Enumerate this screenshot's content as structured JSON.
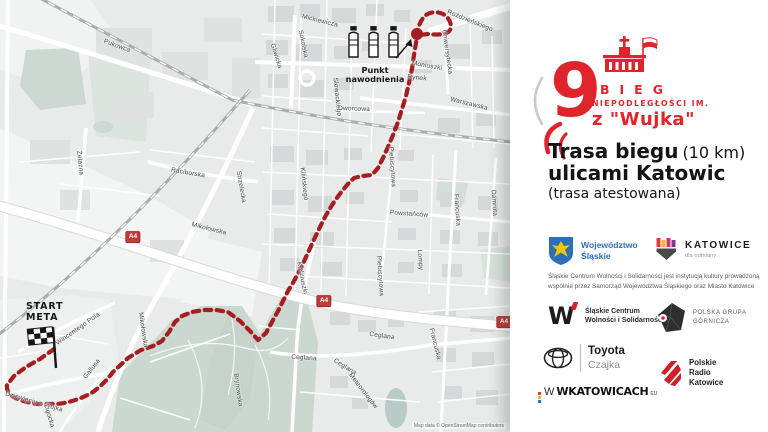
{
  "theme": {
    "route_red": "#a51e21",
    "brand_red": "#e0242c",
    "map_bg": "#e9ebea",
    "park_green": "#cbd8d0",
    "building_gray": "#d6d9d9",
    "road_white": "#ffffff",
    "railway_gray": "#a8aeae",
    "motorway_badge_red": "#c23b3b",
    "slaskie_blue": "#2a70ba",
    "eagle_yellow": "#f6c700"
  },
  "map": {
    "attribution": "Map data © OpenStreetMap contributors",
    "start_marker": {
      "line1": "START",
      "line2": "META"
    },
    "water_point": {
      "line1": "Punkt",
      "line2": "nawodnienia"
    },
    "motorway_badges": [
      {
        "label": "A4",
        "x": 133,
        "y": 237
      },
      {
        "label": "A4",
        "x": 324,
        "y": 301
      },
      {
        "label": "A4",
        "x": 504,
        "y": 322
      }
    ],
    "street_labels": [
      {
        "t": "Pukowca",
        "x": 117,
        "y": 46,
        "r": 20
      },
      {
        "t": "Mickiewicza",
        "x": 320,
        "y": 21,
        "r": 14
      },
      {
        "t": "Sokolska",
        "x": 303,
        "y": 44,
        "r": 78
      },
      {
        "t": "Gliwicka",
        "x": 276,
        "y": 56,
        "r": 72
      },
      {
        "t": "Roździeńskiego",
        "x": 470,
        "y": 21,
        "r": 22
      },
      {
        "t": "Uniwersytecka",
        "x": 447,
        "y": 52,
        "r": 82
      },
      {
        "t": "Moniuszki",
        "x": 427,
        "y": 66,
        "r": 10
      },
      {
        "t": "Rynek",
        "x": 417,
        "y": 78,
        "r": 6
      },
      {
        "t": "Warszawska",
        "x": 469,
        "y": 104,
        "r": 14
      },
      {
        "t": "Słowackiego",
        "x": 337,
        "y": 97,
        "r": 84
      },
      {
        "t": "Dworcowa",
        "x": 354,
        "y": 109,
        "r": 2
      },
      {
        "t": "Żelazna",
        "x": 80,
        "y": 163,
        "r": 84
      },
      {
        "t": "Raciborska",
        "x": 188,
        "y": 173,
        "r": 10
      },
      {
        "t": "Strzelecka",
        "x": 241,
        "y": 187,
        "r": 80
      },
      {
        "t": "Mikołowska",
        "x": 209,
        "y": 229,
        "r": 14
      },
      {
        "t": "Kilińskiego",
        "x": 304,
        "y": 184,
        "r": 84
      },
      {
        "t": "Plebiscytowa",
        "x": 392,
        "y": 167,
        "r": 86
      },
      {
        "t": "Plebiscytowa",
        "x": 380,
        "y": 276,
        "r": 86
      },
      {
        "t": "Powstańców",
        "x": 409,
        "y": 214,
        "r": 4
      },
      {
        "t": "Francuska",
        "x": 457,
        "y": 210,
        "r": 86
      },
      {
        "t": "Damrota",
        "x": 494,
        "y": 203,
        "r": 86
      },
      {
        "t": "Lompy",
        "x": 420,
        "y": 260,
        "r": 86
      },
      {
        "t": "Kościuszki",
        "x": 302,
        "y": 278,
        "r": 78
      },
      {
        "t": "Wincentego Pola",
        "x": 78,
        "y": 329,
        "r": -35
      },
      {
        "t": "Gallusa",
        "x": 92,
        "y": 369,
        "r": -52
      },
      {
        "t": "Mikołowska",
        "x": 143,
        "y": 330,
        "r": 82
      },
      {
        "t": "Dziewięciu z Wujka",
        "x": 34,
        "y": 402,
        "r": 16
      },
      {
        "t": "Ligocka",
        "x": 49,
        "y": 416,
        "r": 74
      },
      {
        "t": "Brynowska",
        "x": 238,
        "y": 390,
        "r": 82
      },
      {
        "t": "Ceglana",
        "x": 382,
        "y": 336,
        "r": 8
      },
      {
        "t": "Ceglana",
        "x": 304,
        "y": 358,
        "r": 4
      },
      {
        "t": "Ceglana",
        "x": 345,
        "y": 367,
        "r": 32
      },
      {
        "t": "Meteorologów",
        "x": 363,
        "y": 391,
        "r": 52
      },
      {
        "t": "Francuska",
        "x": 435,
        "y": 344,
        "r": 76
      }
    ]
  },
  "panel": {
    "logo": {
      "number": "9",
      "line1": "BIEG",
      "line2": "NIEPODLEGŁOŚCI IM.",
      "line3": "z \"Wujka\""
    },
    "title": {
      "bold1": "Trasa biegu",
      "normal1": "(10 km)",
      "bold2": "ulicami Katowic",
      "normal2": "(trasa atestowana)"
    },
    "note": "Śląskie Centrum Wolności i Solidarności jest instytucją kultury prowadzoną wspólnie przez Samorząd Województwa Śląskiego oraz Miasto Katowice",
    "logos": {
      "slaskie": {
        "line1": "Województwo",
        "line2": "Śląskie"
      },
      "katowice": {
        "name": "KATOWICE",
        "tagline": "dla odmiany"
      },
      "scws": {
        "line1": "Śląskie Centrum",
        "line2": "Wolności i Solidarności"
      },
      "pgg": {
        "line1": "POLSKA GRUPA",
        "line2": "GÓRNICZA"
      },
      "toyota": {
        "line1": "Toyota",
        "line2": "Czajka"
      },
      "radio": {
        "line1": "Polskie",
        "line2": "Radio",
        "line3": "Katowice"
      },
      "wkatowicach": {
        "text": "WKATOWICACH",
        "suffix": "EU"
      }
    }
  }
}
